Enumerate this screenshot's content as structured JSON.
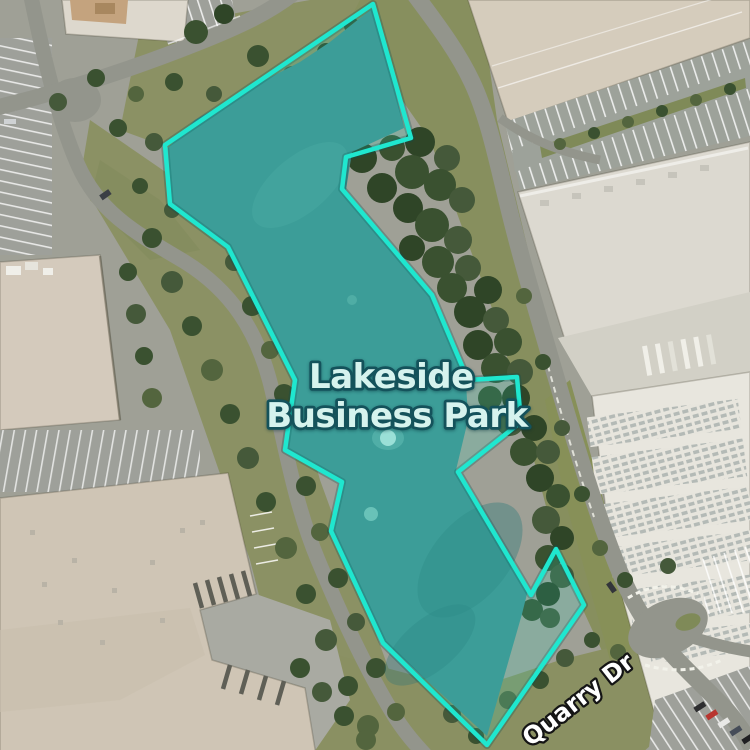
{
  "map": {
    "area_label": {
      "line1": "Lakeside",
      "line2": "Business Park"
    },
    "street_label": "Quarry Dr",
    "overlay": {
      "points": "373,4 411,138 346,157 342,189 432,295 468,380 517,377 521,422 458,472 531,595 556,549 584,605 487,745 383,643 331,531 342,482 285,450 295,380 228,247 170,204 165,145",
      "stroke_color": "#1fe7cf",
      "fill_color": "rgba(35,228,202,0.17)"
    },
    "colors": {
      "lake": "#41908e",
      "area_label_fill": "#d6f3ee",
      "area_label_outline": "#14525b",
      "street_label_fill": "#ffffff",
      "street_label_outline": "#141414"
    }
  }
}
